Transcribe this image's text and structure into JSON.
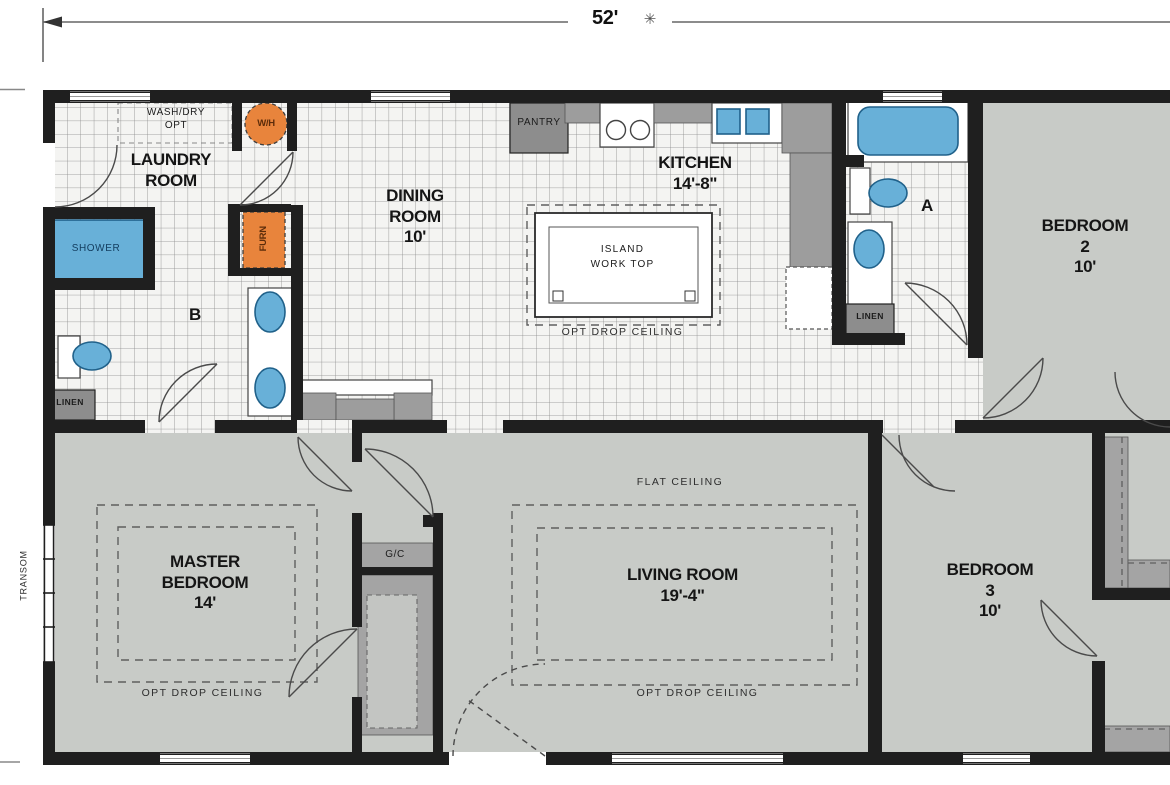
{
  "dimension": {
    "width_label": "52'",
    "marker": "✳"
  },
  "labels": {
    "laundry_title": "LAUNDRY\nROOM",
    "washdry": "WASH/DRY\nOPT",
    "wh": "W/H",
    "furn": "FURN",
    "shower": "SHOWER",
    "bath_b_letter": "B",
    "linen_b": "LINEN",
    "dining_title": "DINING\nROOM\n10'",
    "pantry": "PANTRY",
    "kitchen_title": "KITCHEN\n14'-8\"",
    "island": "ISLAND\nWORK TOP",
    "opt_drop_kitchen": "OPT DROP CEILING",
    "bath_a_letter": "A",
    "linen_a": "LINEN",
    "bedroom2_title": "BEDROOM\n2\n10'",
    "transom": "TRANSOM",
    "master_title": "MASTER\nBEDROOM\n14'",
    "opt_drop_master": "OPT DROP CEILING",
    "gc": "G/C",
    "flat_ceiling": "FLAT CEILING",
    "living_title": "LIVING ROOM\n19'-4\"",
    "opt_drop_living": "OPT DROP CEILING",
    "bedroom3_title": "BEDROOM\n3\n10'"
  },
  "colors": {
    "wall": "#1f1f1f",
    "blue": "#68b0d8",
    "orange": "#e8843c",
    "floor_gray": "#c8cbc7",
    "counter": "#9d9d9d",
    "cabinet": "#8d8d8d",
    "closetc": "#a4a4a4"
  }
}
